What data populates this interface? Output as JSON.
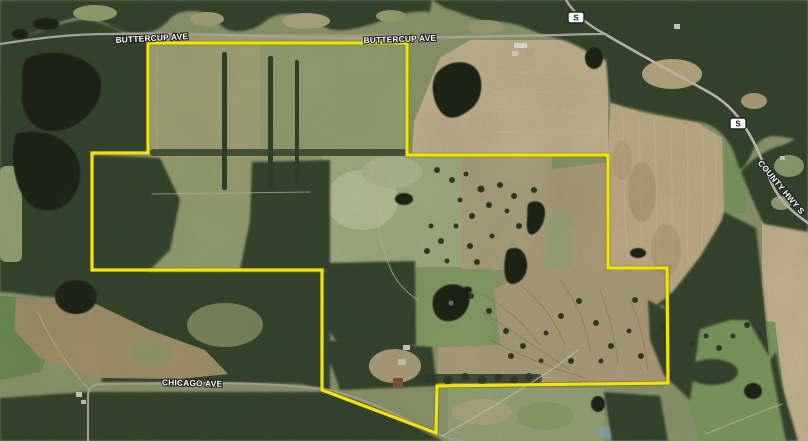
{
  "map": {
    "view": "aerial-satellite",
    "road_labels": [
      {
        "id": "buttercup-ave-west",
        "text": "BUTTERCUP AVE"
      },
      {
        "id": "buttercup-ave-east",
        "text": "BUTTERCUP AVE"
      },
      {
        "id": "chicago-ave",
        "text": "CHICAGO AVE"
      },
      {
        "id": "county-hwy-s",
        "text": "COUNTY HWY S"
      }
    ],
    "shields": [
      {
        "id": "county-s-shield-north",
        "text": "S"
      },
      {
        "id": "county-s-shield-east",
        "text": "S"
      }
    ],
    "boundary": {
      "color": "#f2e30a",
      "label": "property-parcel-outline"
    }
  }
}
